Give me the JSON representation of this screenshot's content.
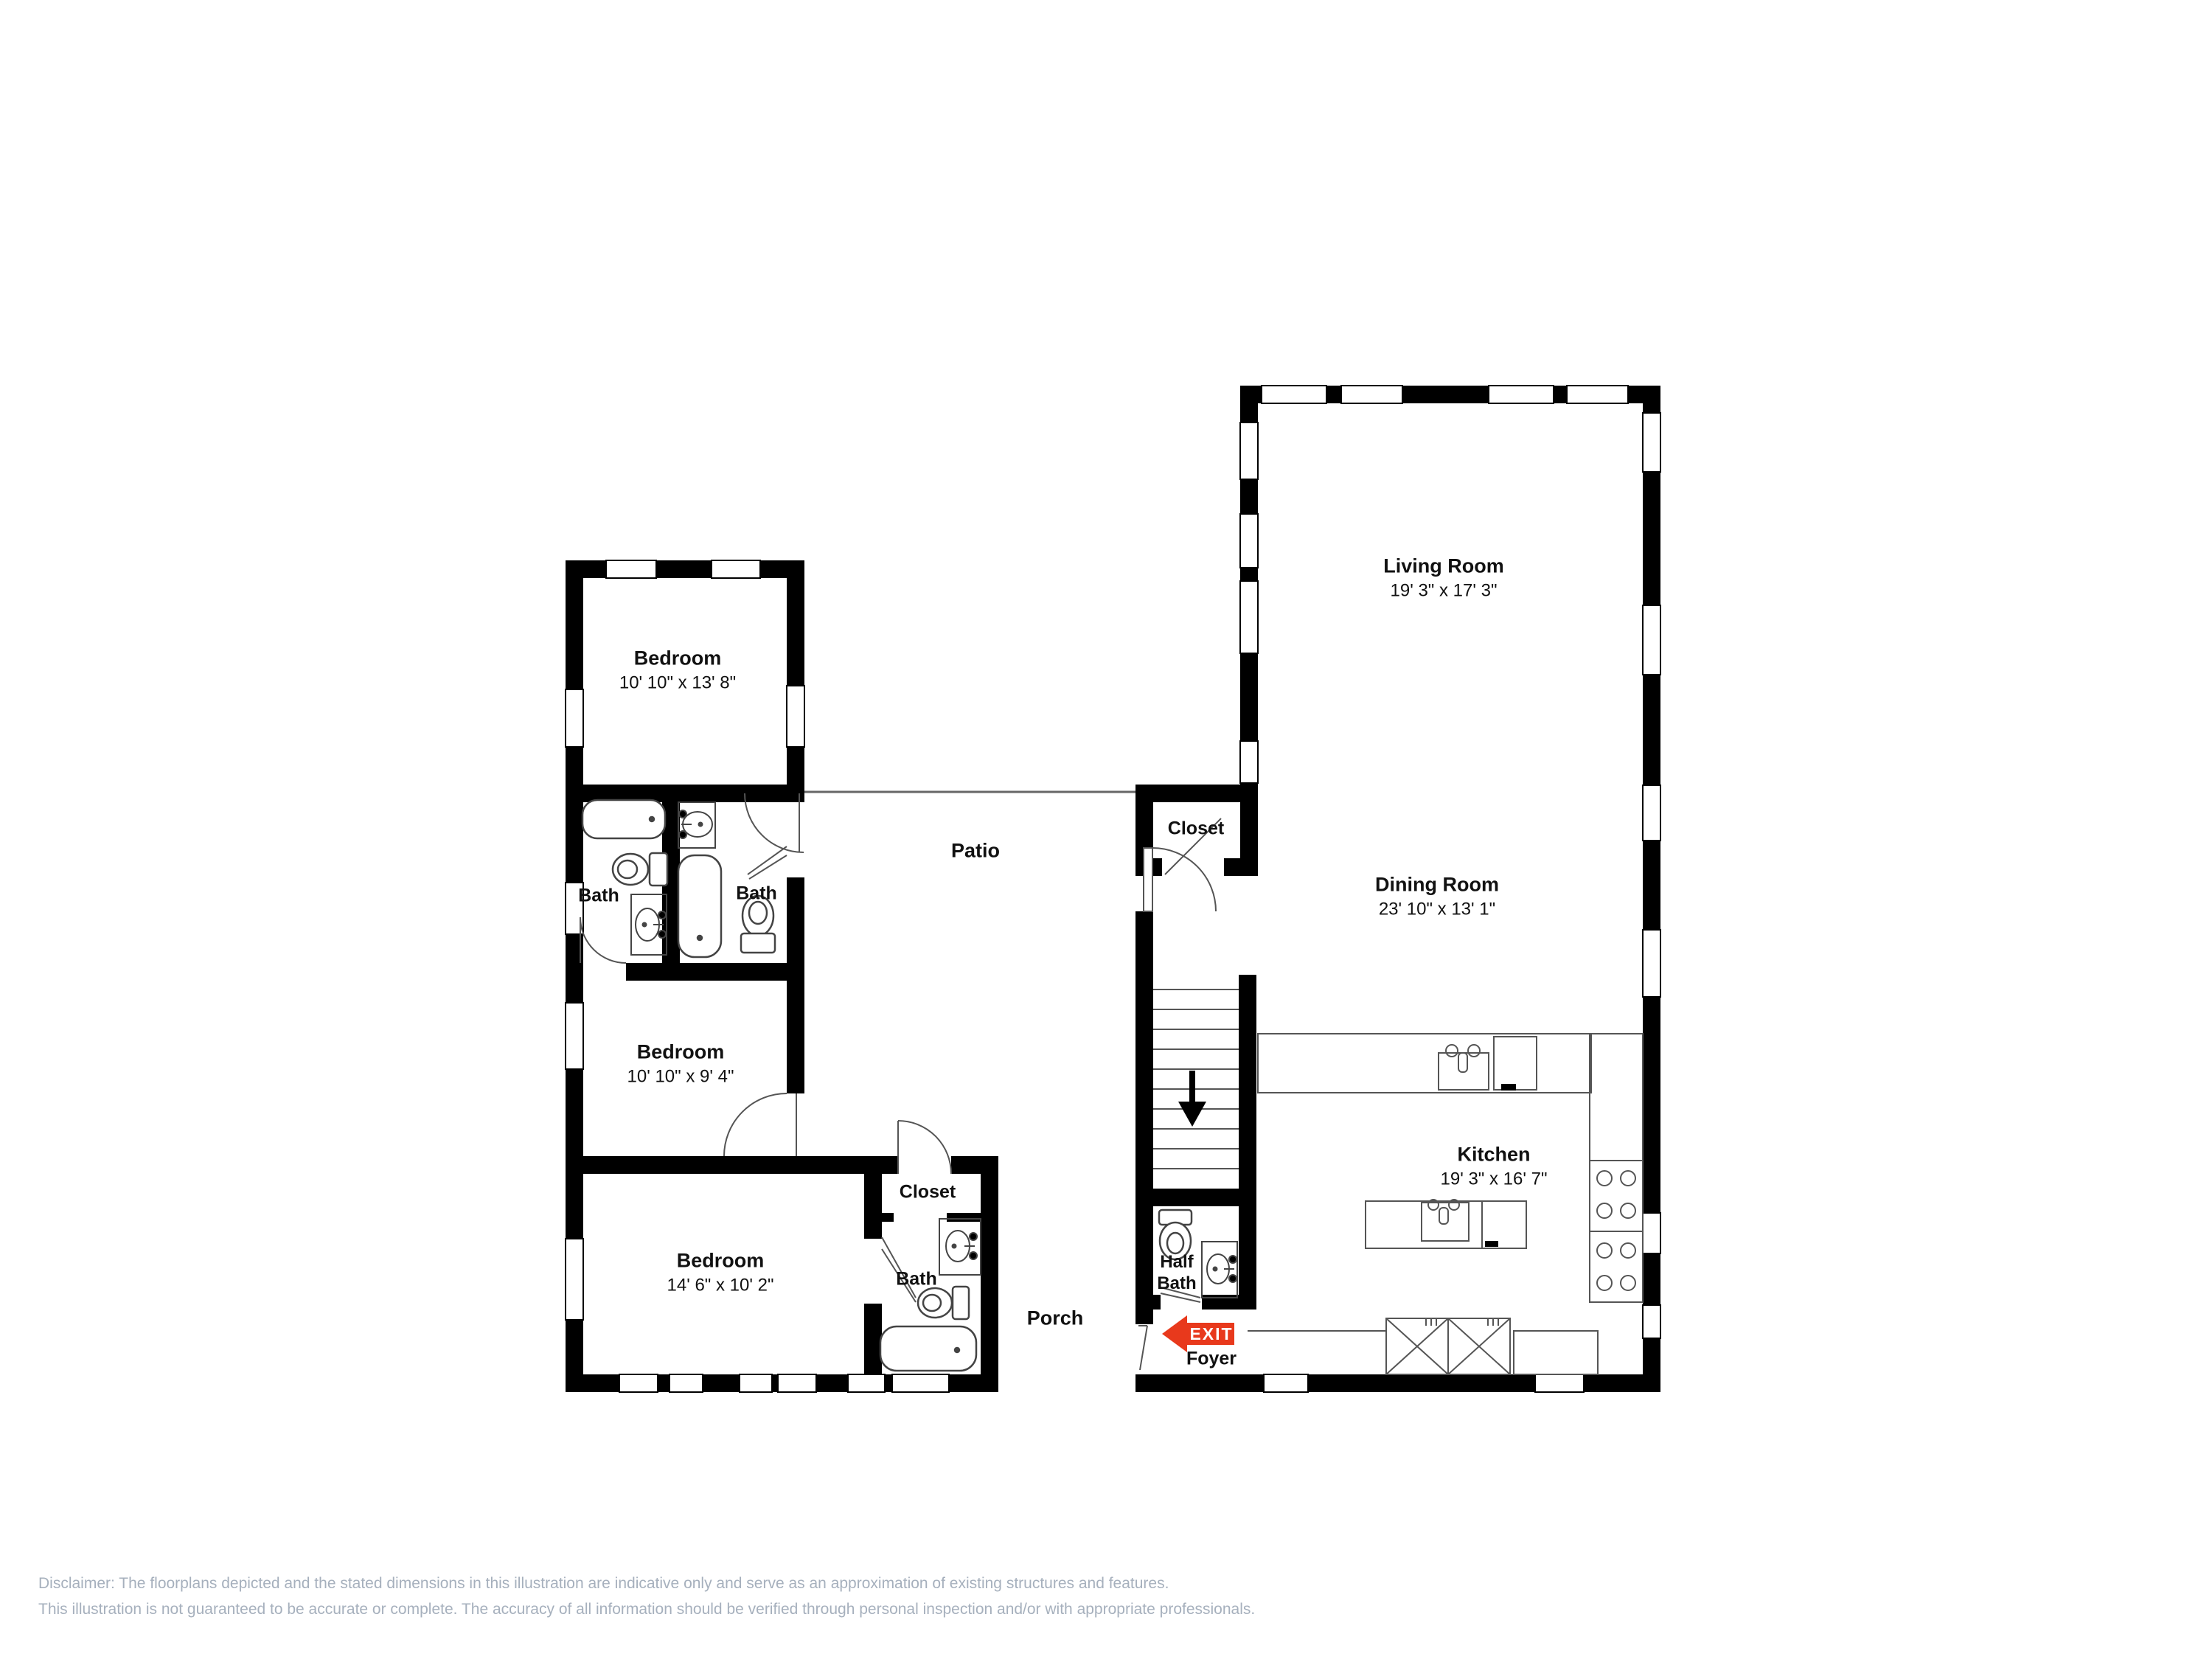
{
  "floorplan": {
    "rooms": [
      {
        "name": "Living Room",
        "dims": "19' 3\" x 17' 3\""
      },
      {
        "name": "Dining Room",
        "dims": "23' 10\" x 13' 1\""
      },
      {
        "name": "Kitchen",
        "dims": "19' 3\" x 16' 7\""
      },
      {
        "name": "Bedroom",
        "dims": "10' 10\" x 13' 8\""
      },
      {
        "name": "Bedroom",
        "dims": "10' 10\" x 9' 4\""
      },
      {
        "name": "Bedroom",
        "dims": "14' 6\" x 10' 2\""
      }
    ],
    "labels": {
      "bath_left": "Bath",
      "bath_right": "Bath",
      "bath_bottom": "Bath",
      "half_bath": "Half Bath",
      "closet_upper": "Closet",
      "closet_lower": "Closet",
      "patio": "Patio",
      "porch": "Porch",
      "foyer": "Foyer"
    },
    "exit_sign": {
      "label": "EXIT",
      "color": "#e8391c"
    },
    "stairs": {
      "direction": "down"
    }
  },
  "disclaimer": {
    "line1": "Disclaimer: The floorplans depicted and the stated dimensions in this illustration are indicative only and serve as an approximation of existing structures and features.",
    "line2": "This illustration is not guaranteed to be accurate or complete. The accuracy of all information should be verified through personal inspection and/or with appropriate professionals."
  }
}
